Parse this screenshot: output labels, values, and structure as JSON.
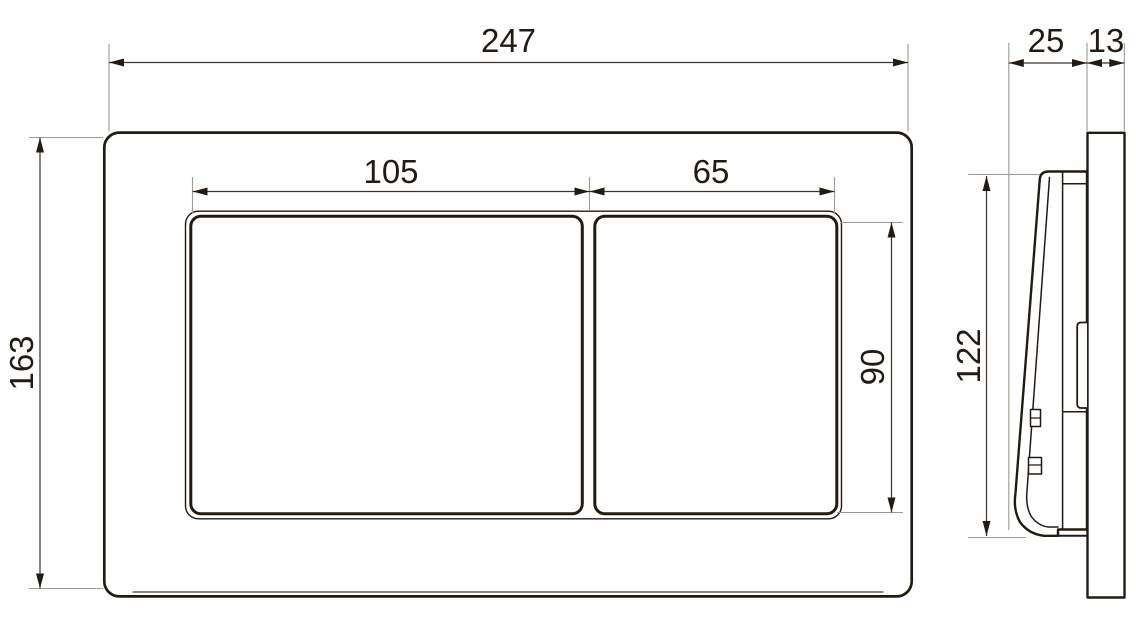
{
  "diagram_type": "technical-dimension-drawing",
  "subject": "dual-flush-plate",
  "front_view": {
    "plate_width": "247",
    "plate_height": "163",
    "large_button_width": "105",
    "small_button_width": "65",
    "button_height": "90"
  },
  "side_view": {
    "plate_depth": "25",
    "frame_thickness": "13",
    "plate_face_height": "122"
  },
  "colors": {
    "line": "#221b13",
    "dim_line": "#39342e",
    "ext_line": "#9c9a95",
    "background": "#ffffff"
  }
}
